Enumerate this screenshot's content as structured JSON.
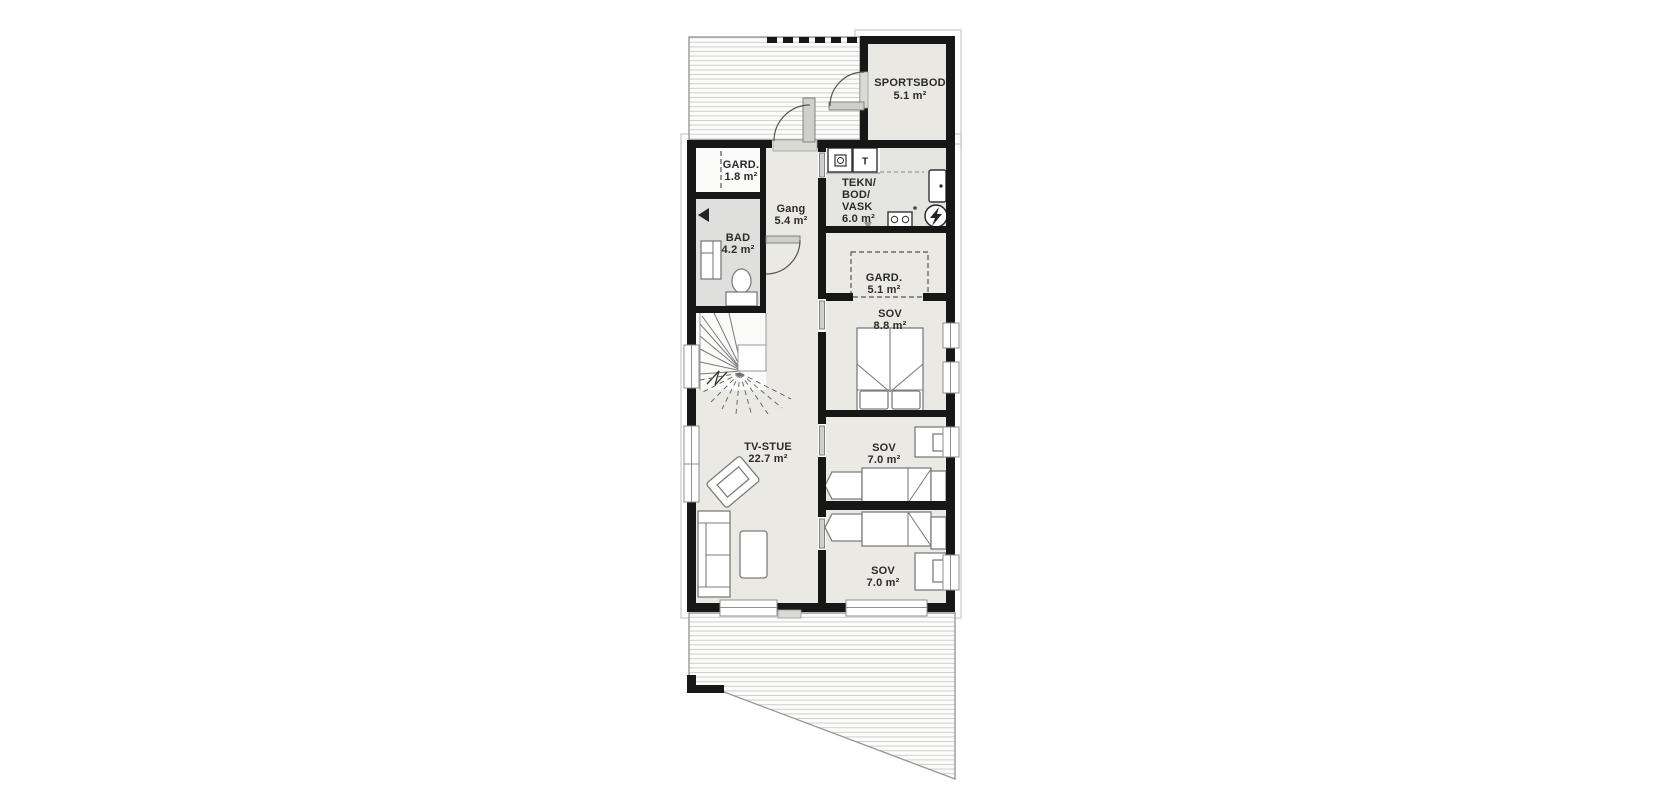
{
  "plan": {
    "type": "floor-plan",
    "colors": {
      "wall": "#171717",
      "floor_main": "#eae9e4",
      "floor_bad": "#dfdfdd",
      "floor_tekn": "#e4e4e1",
      "floor_storage": "#e9e8e3",
      "floor_white": "#fbfbfa",
      "deck_edge": "#9a9a9a",
      "deck_line": "#cfcecb",
      "outline": "#c7c7c4",
      "frame": "#8f8f8f",
      "sill": "#d9d9d6",
      "door_leaf": "#cfcfcd",
      "furniture": "#7d7d7d",
      "text": "#2b2b2b"
    },
    "rooms": [
      {
        "id": "sportsbod",
        "lines": [
          "SPORTSBOD",
          "5.1 m²"
        ]
      },
      {
        "id": "gard-entre",
        "lines": [
          "GARD.",
          "1.8 m²"
        ]
      },
      {
        "id": "bad",
        "lines": [
          "BAD",
          "4.2 m²"
        ]
      },
      {
        "id": "gang",
        "lines": [
          "Gang",
          "5.4 m²"
        ]
      },
      {
        "id": "tekn-bod-vask",
        "lines": [
          "TEKN/",
          "BOD/",
          "VASK",
          "6.0 m²"
        ]
      },
      {
        "id": "gard-sov",
        "lines": [
          "GARD.",
          "5.1 m²"
        ]
      },
      {
        "id": "sov-8-8",
        "lines": [
          "SOV",
          "8.8 m²"
        ]
      },
      {
        "id": "tv-stue",
        "lines": [
          "TV-STUE",
          "22.7 m²"
        ]
      },
      {
        "id": "sov-7-0-a",
        "lines": [
          "SOV",
          "7.0 m²"
        ]
      },
      {
        "id": "sov-7-0-b",
        "lines": [
          "SOV",
          "7.0 m²"
        ]
      }
    ],
    "symbols": {
      "dryer": "T"
    }
  }
}
